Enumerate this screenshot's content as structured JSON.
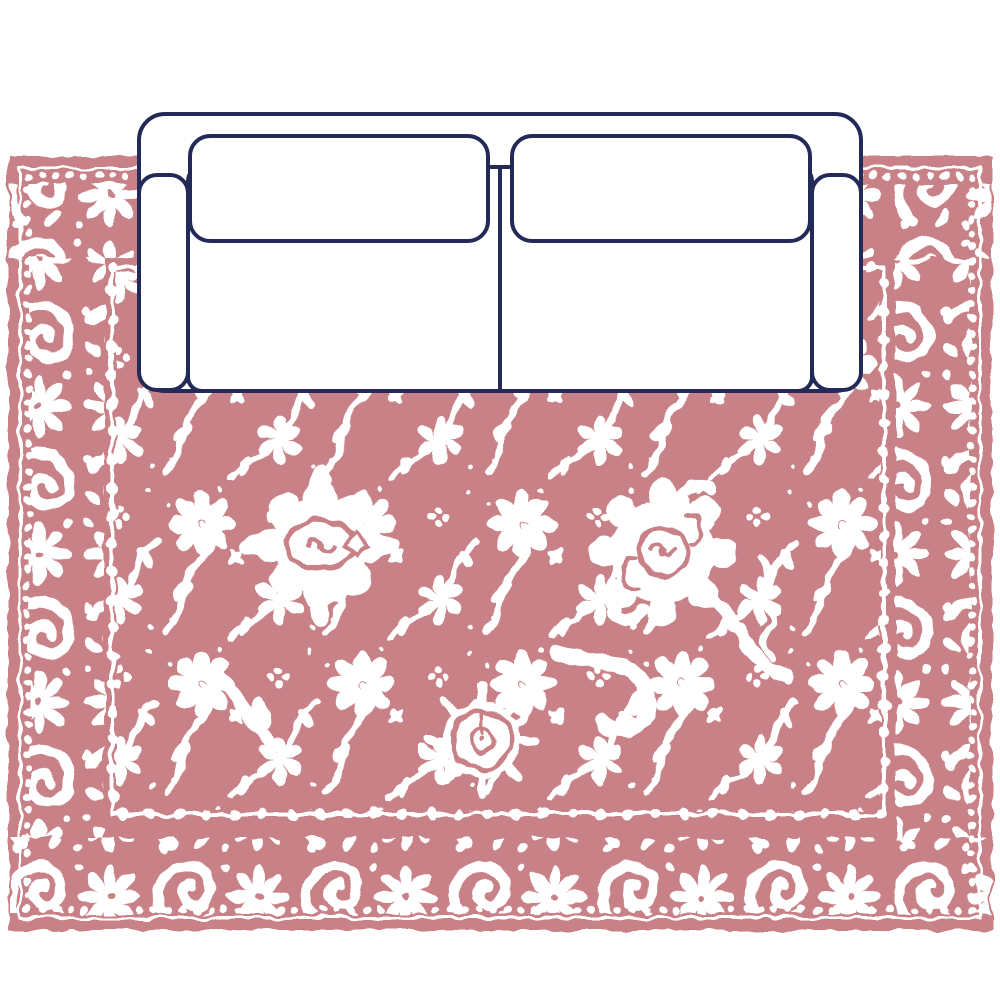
{
  "scene": {
    "label": "Top-down interior plan view: two-seat sofa centered on an ornate oriental area rug",
    "background": "#ffffff"
  },
  "colors": {
    "page-bg": "#ffffff",
    "rug-pink": "#c88287",
    "pattern-white": "#ffffff",
    "sofa-outline": "#242a57",
    "sofa-fill": "#ffffff"
  },
  "rug": {
    "label": "oriental area rug, top view",
    "style": "white floral field pattern with paisley-and-rosette border bands, bead-chain guard stripes, two round medallions and a pomegranate roundel",
    "primary_color": "#c88287",
    "pattern_color": "#ffffff"
  },
  "sofa": {
    "label": "two-seat sofa, top view",
    "outline_color": "#242a57",
    "fill_color": "#ffffff",
    "seat_count": 2,
    "back_cushion_count": 2,
    "armrest_count": 2
  }
}
